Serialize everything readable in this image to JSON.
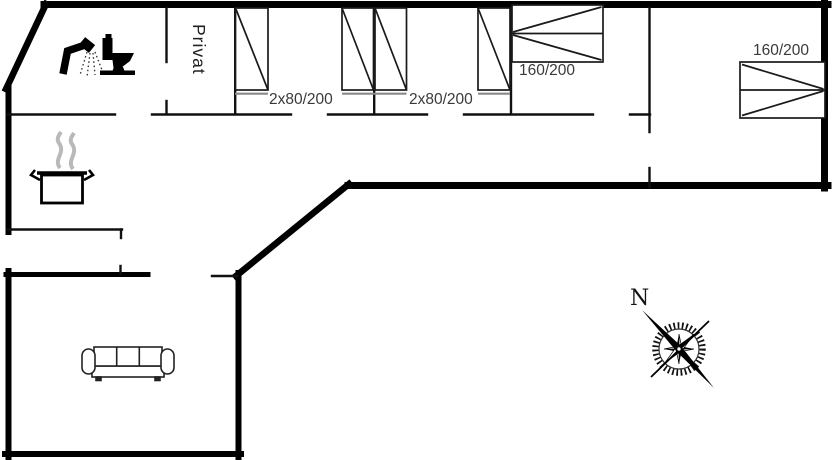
{
  "plan": {
    "labels": {
      "privat": "Privat",
      "bedroom_a": "2x80/200",
      "bedroom_b": "2x80/200",
      "bedroom_c": "160/200",
      "bedroom_d": "160/200"
    },
    "compass": {
      "north": "N"
    },
    "icons": {
      "shower": "shower-icon",
      "toilet": "toilet-icon",
      "cooking_pot": "cooking-pot-icon",
      "sofa": "sofa-icon",
      "compass_rose": "compass-rose-icon"
    },
    "colors": {
      "exterior_wall": "#000000",
      "interior_wall": "#111111",
      "bed_outline": "#1a1a1a",
      "bed_foot_line": "#8a8a8a",
      "label_text": "#3a3a3a",
      "steam": "#b9b9b9",
      "background": "#ffffff"
    }
  }
}
